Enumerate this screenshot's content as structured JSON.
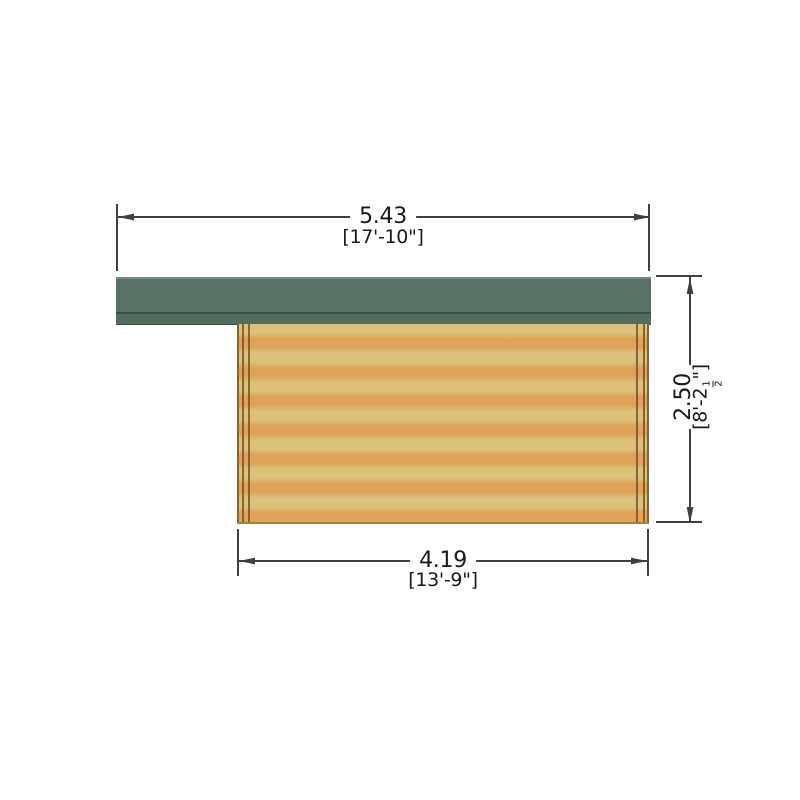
{
  "colors": {
    "background": "#ffffff",
    "roof_main": "#597065",
    "roof_divider": "#3c4f44",
    "roof_fascia": "#546c5e",
    "roof_highlight": "#768b7d",
    "wall_light": "#dcc17b",
    "wall_band": "#dfa258",
    "wall_edge": "#8a6134",
    "wall_trim": "#7a5426",
    "wall_base": "#a57f44",
    "dim_line": "#3f3f3f",
    "text": "#1a1a1a"
  },
  "dimensions": {
    "top": {
      "metric": "5.43",
      "imperial": "[17'-10\"]"
    },
    "bottom": {
      "metric": "4.19",
      "imperial": "[13'-9\"]"
    },
    "right": {
      "metric": "2.50",
      "imperial_prefix": "[8'-2",
      "fraction_numerator": "1",
      "fraction_denominator": "2",
      "imperial_suffix": "\"]"
    }
  }
}
